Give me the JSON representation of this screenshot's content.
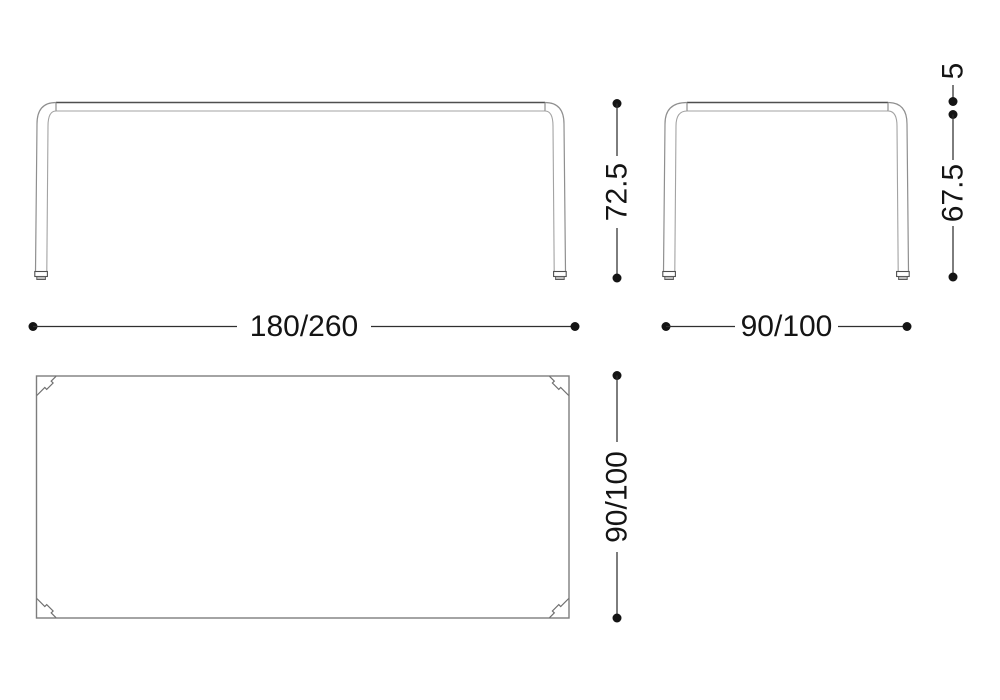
{
  "drawing": {
    "type": "furniture-dimension-diagram",
    "front_view": {
      "height_label": "72.5",
      "width_label": "180/260"
    },
    "side_view": {
      "top_thickness_label": "5",
      "leg_height_label": "67.5",
      "width_label": "90/100"
    },
    "plan_view": {
      "depth_label": "90/100"
    },
    "colors": {
      "background": "#ffffff",
      "outline_gray": "#8f8f8f",
      "outline_dark": "#4f4f4f",
      "dimension_ink": "#141414"
    }
  }
}
